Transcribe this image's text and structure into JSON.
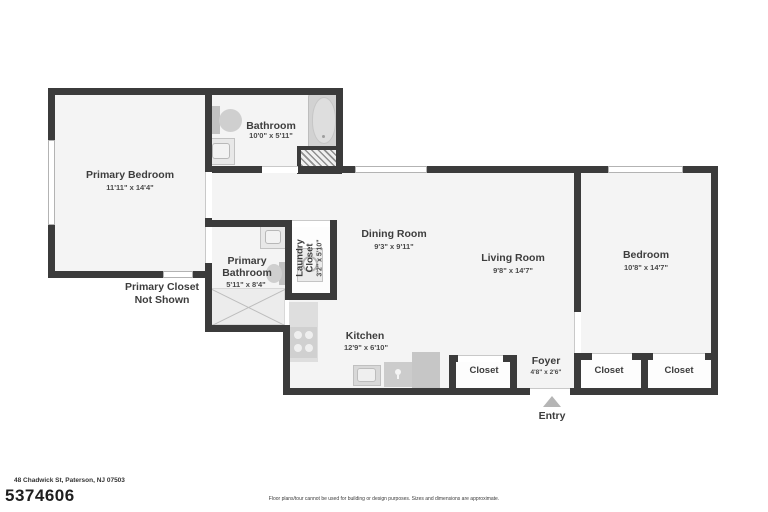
{
  "meta": {
    "address": "48 Chadwick St, Paterson, NJ 07503",
    "listing_id": "5374606",
    "disclaimer": "Floor plans/tour cannot be used for building or design purposes. Sizes and dimensions are approximate."
  },
  "rooms": {
    "primary_bedroom": {
      "name": "Primary Bedroom",
      "dims": "11'11\" x 14'4\""
    },
    "bathroom": {
      "name": "Bathroom",
      "dims": "10'0\" x 5'11\""
    },
    "primary_bathroom": {
      "name_line1": "Primary",
      "name_line2": "Bathroom",
      "dims": "5'11\" x 8'4\""
    },
    "laundry_closet": {
      "name_line1": "Laundry",
      "name_line2": "Closet",
      "dims": "3'2\" x 5'10\""
    },
    "dining_room": {
      "name": "Dining Room",
      "dims": "9'3\" x 9'11\""
    },
    "living_room": {
      "name": "Living Room",
      "dims": "9'8\" x 14'7\""
    },
    "kitchen": {
      "name": "Kitchen",
      "dims": "12'9\" x 6'10\""
    },
    "bedroom": {
      "name": "Bedroom",
      "dims": "10'8\" x 14'7\""
    },
    "foyer": {
      "name": "Foyer",
      "dims": "4'8\" x 2'6\""
    },
    "closet_foyer": {
      "name": "Closet"
    },
    "closet_bedroom_left": {
      "name": "Closet"
    },
    "closet_bedroom_right": {
      "name": "Closet"
    }
  },
  "notes": {
    "primary_closet_line1": "Primary Closet",
    "primary_closet_line2": "Not Shown",
    "entry_label": "Entry"
  },
  "colors": {
    "wall": "#3b3b3b",
    "room_fill": "#f4f4f4",
    "closet_fill": "#fdfdfd",
    "fixture": "#d6d6d6",
    "text": "#3d3d3d"
  }
}
